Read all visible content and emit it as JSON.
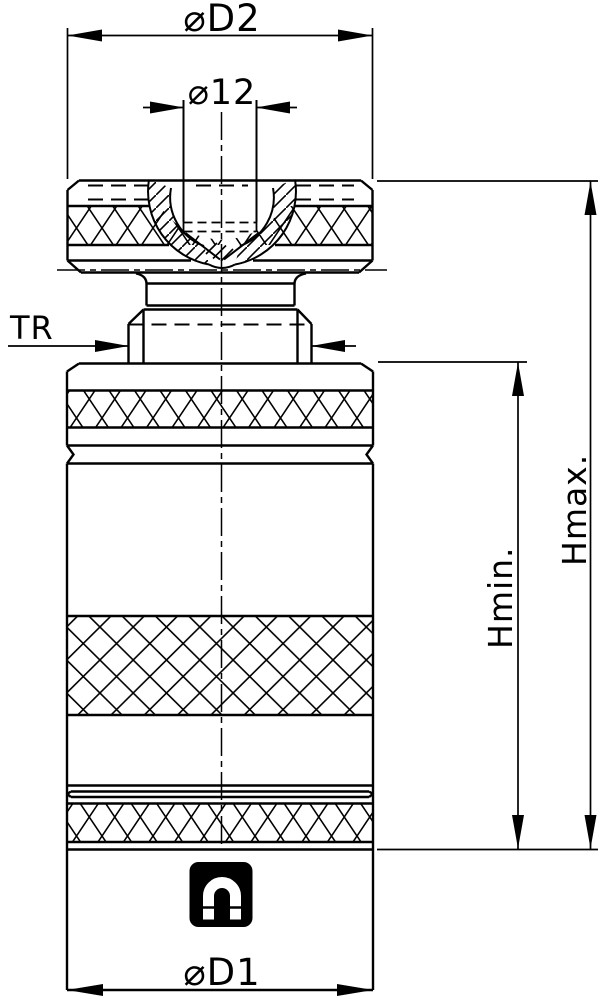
{
  "drawing": {
    "title": "adjustable-screw-support-technical-drawing",
    "labels": {
      "d2": "⌀D2",
      "d12": "⌀12",
      "tr": "TR",
      "hmin": "Hmin.",
      "hmax": "Hmax.",
      "d1": "⌀D1"
    },
    "icons": {
      "magnet": "magnet-icon"
    },
    "colors": {
      "line": "#000000",
      "background": "#ffffff"
    }
  }
}
